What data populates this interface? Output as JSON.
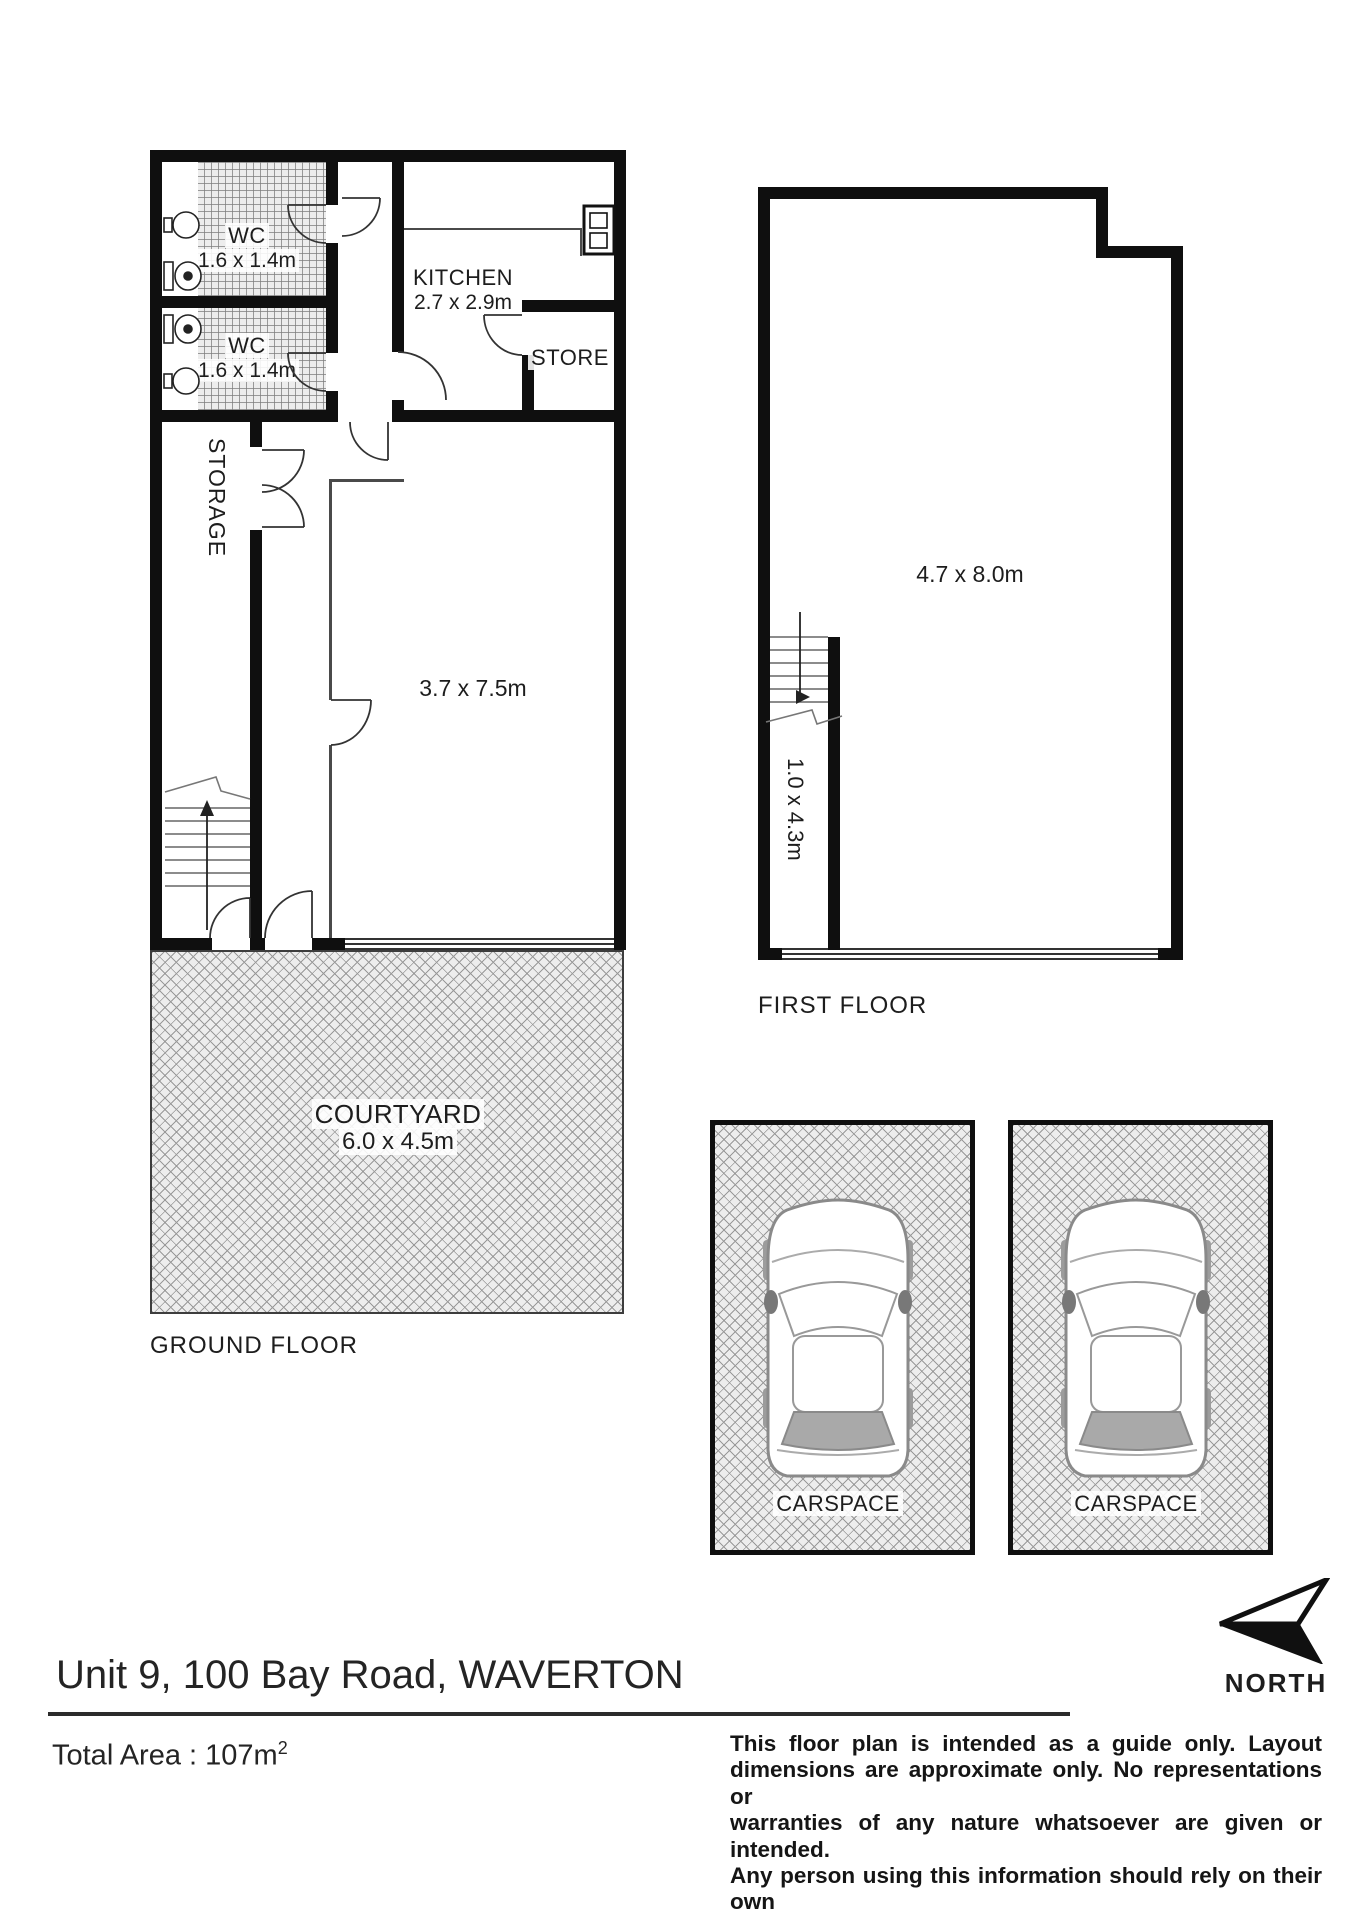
{
  "header": {
    "address": "Unit 9, 100 Bay Road, WAVERTON"
  },
  "total_area": {
    "label": "Total Area :",
    "value": "107m",
    "exponent": "2"
  },
  "north": {
    "label": "NORTH"
  },
  "ground_floor": {
    "label": "GROUND FLOOR",
    "wc1": {
      "name": "WC",
      "dims": "1.6 x 1.4m"
    },
    "wc2": {
      "name": "WC",
      "dims": "1.6 x 1.4m"
    },
    "kitchen": {
      "name": "KITCHEN",
      "dims": "2.7 x 2.9m"
    },
    "store": {
      "name": "STORE"
    },
    "storage": {
      "name": "STORAGE"
    },
    "main_room": {
      "dims": "3.7 x 7.5m"
    },
    "entry": {
      "label": "ENTRY"
    },
    "courtyard": {
      "name": "COURTYARD",
      "dims": "6.0 x 4.5m"
    }
  },
  "first_floor": {
    "label": "FIRST FLOOR",
    "main_room": {
      "dims": "4.7 x 8.0m"
    },
    "stairs": {
      "dims": "1.0 x 4.3m"
    }
  },
  "carspaces": {
    "one": {
      "label": "CARSPACE"
    },
    "two": {
      "label": "CARSPACE"
    }
  },
  "disclaimer": {
    "lines": [
      "This floor plan is intended as a guide only. Layout",
      "dimensions are approximate only. No representations or",
      "warranties of any nature whatsoever are given or intended.",
      "Any person using this information should rely on their own",
      "enquiries. Floor Plans by SURROUNDPIX."
    ]
  }
}
